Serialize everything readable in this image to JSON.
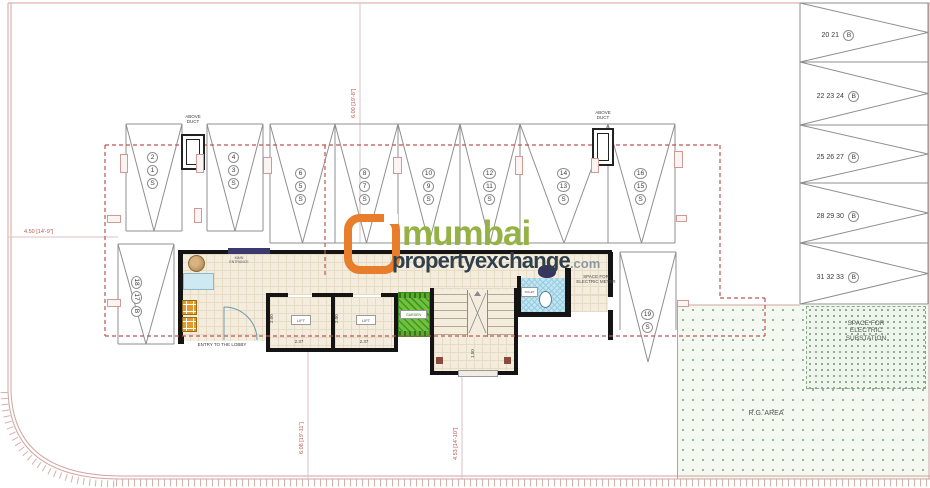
{
  "watermark": {
    "word1": "mumbai",
    "word2": "propertyexchange",
    "suffix": ".com"
  },
  "stalls": {
    "upper": [
      {
        "top": "2",
        "mid": "1",
        "type": "S"
      },
      {
        "top": "4",
        "mid": "3",
        "type": "S"
      },
      {
        "top": "6",
        "mid": "5",
        "type": "S"
      },
      {
        "top": "8",
        "mid": "7",
        "type": "S"
      },
      {
        "top": "10",
        "mid": "9",
        "type": "S"
      },
      {
        "top": "12",
        "mid": "11",
        "type": "S"
      },
      {
        "top": "14",
        "mid": "13",
        "type": "S"
      },
      {
        "top": "16",
        "mid": "15",
        "type": "S"
      }
    ],
    "right": [
      {
        "nums": "20 21",
        "type": "B"
      },
      {
        "nums": "22 23 24",
        "type": "B"
      },
      {
        "nums": "25 26 27",
        "type": "B"
      },
      {
        "nums": "28 29 30",
        "type": "B"
      },
      {
        "nums": "31 32 33",
        "type": "B"
      }
    ],
    "west": {
      "first": "18",
      "second": "17",
      "type": "B"
    },
    "south": {
      "first": "19",
      "type": "S"
    }
  },
  "ducts": {
    "label": "ABOVE DUCT"
  },
  "lobby": {
    "entry_label": "ENTRY TO THE LOBBY",
    "entrance_label": "MAIN ENTRANCE"
  },
  "rooms": {
    "lift": "LIFT",
    "garden": "GARDEN",
    "toilet": "TOILET",
    "electric_meter": "SPACE FOR ELECTRIC METER",
    "substation": "SPACE FOR ELECTRIC SUBSTATION",
    "rg_area": "R.G. AREA"
  },
  "dimensions": {
    "plot_left": "4.50 [14'-9\"]",
    "top_span": "6.00 [19'-8\"]",
    "lobby_depth": "6.08 [19'-11\"]",
    "stair_depth": "4.53 [14'-10\"]",
    "lift_width": "2.37",
    "lift_depth": "2.00",
    "stair_width": "1.50"
  },
  "colors": {
    "boundary": "#d0a3a0",
    "dash_line": "#bf5450",
    "dim_text": "#bf5450",
    "stall_line": "#8f8f8f",
    "wall": "#141414",
    "floor": "#f4ecdd",
    "desk": "#cfe9f2",
    "chair": "#e09a2d",
    "garden_green": "#6fc13e",
    "toilet_blue": "#c3e5f1",
    "logo_frame": "#e87d2b",
    "logo_green": "#95b345",
    "logo_dark": "#31404d",
    "logo_gray": "#8c98a0"
  }
}
